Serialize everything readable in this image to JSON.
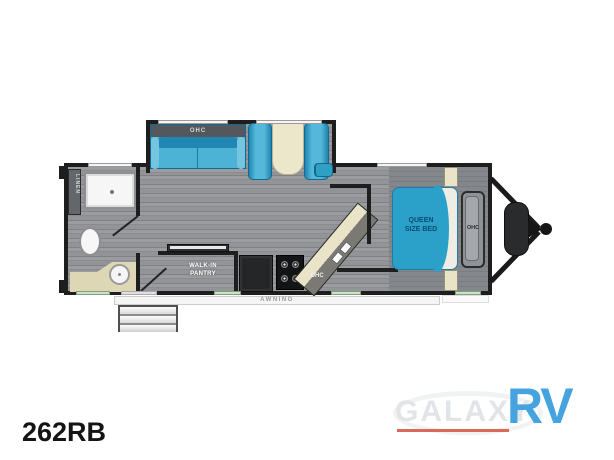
{
  "floorplan": {
    "labels": {
      "linen": "LINEN",
      "sofa_ohc": "OHC",
      "kitchen_ohc": "OHC",
      "wardrobe_ohc": "OHC",
      "bed_line1": "QUEEN",
      "bed_line2": "SIZE BED",
      "pantry_line1": "WALK-IN",
      "pantry_line2": "PANTRY",
      "awning": "AWNING"
    },
    "colors": {
      "wall": "#1e1e1e",
      "furniture_blue": "#2ba1c9",
      "counter_tan": "#e9e3c7",
      "floor_gray": "#929497",
      "window_green": "#cfe0ca"
    }
  },
  "branding": {
    "model_number": "262RB",
    "logo_galaxy": "GALAXY",
    "logo_rv": "RV",
    "logo_rv_color": "#45a4e0",
    "logo_underline_color": "#d9695a"
  }
}
